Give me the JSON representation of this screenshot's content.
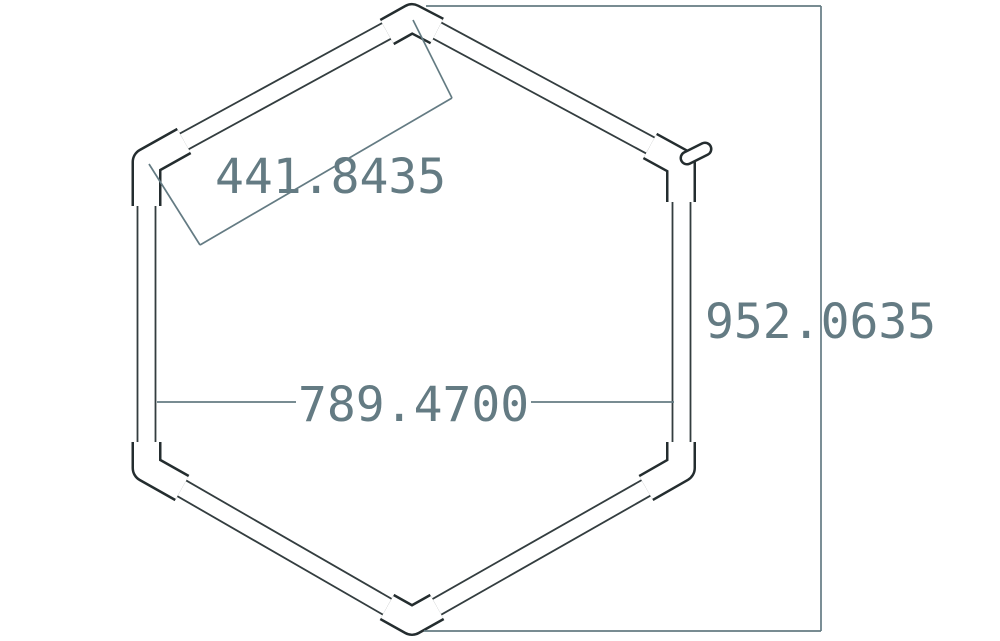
{
  "drawing": {
    "dimensions": [
      {
        "id": "aligned-edge-length",
        "value": "441.8435"
      },
      {
        "id": "vertical-extent",
        "value": "952.0635"
      },
      {
        "id": "horizontal-width",
        "value": "789.4700"
      }
    ]
  },
  "colors": {
    "background": "#ffffff",
    "tube_outline": "#333d3f",
    "connector_outline": "#242d2f",
    "dimension": "#647b83"
  }
}
